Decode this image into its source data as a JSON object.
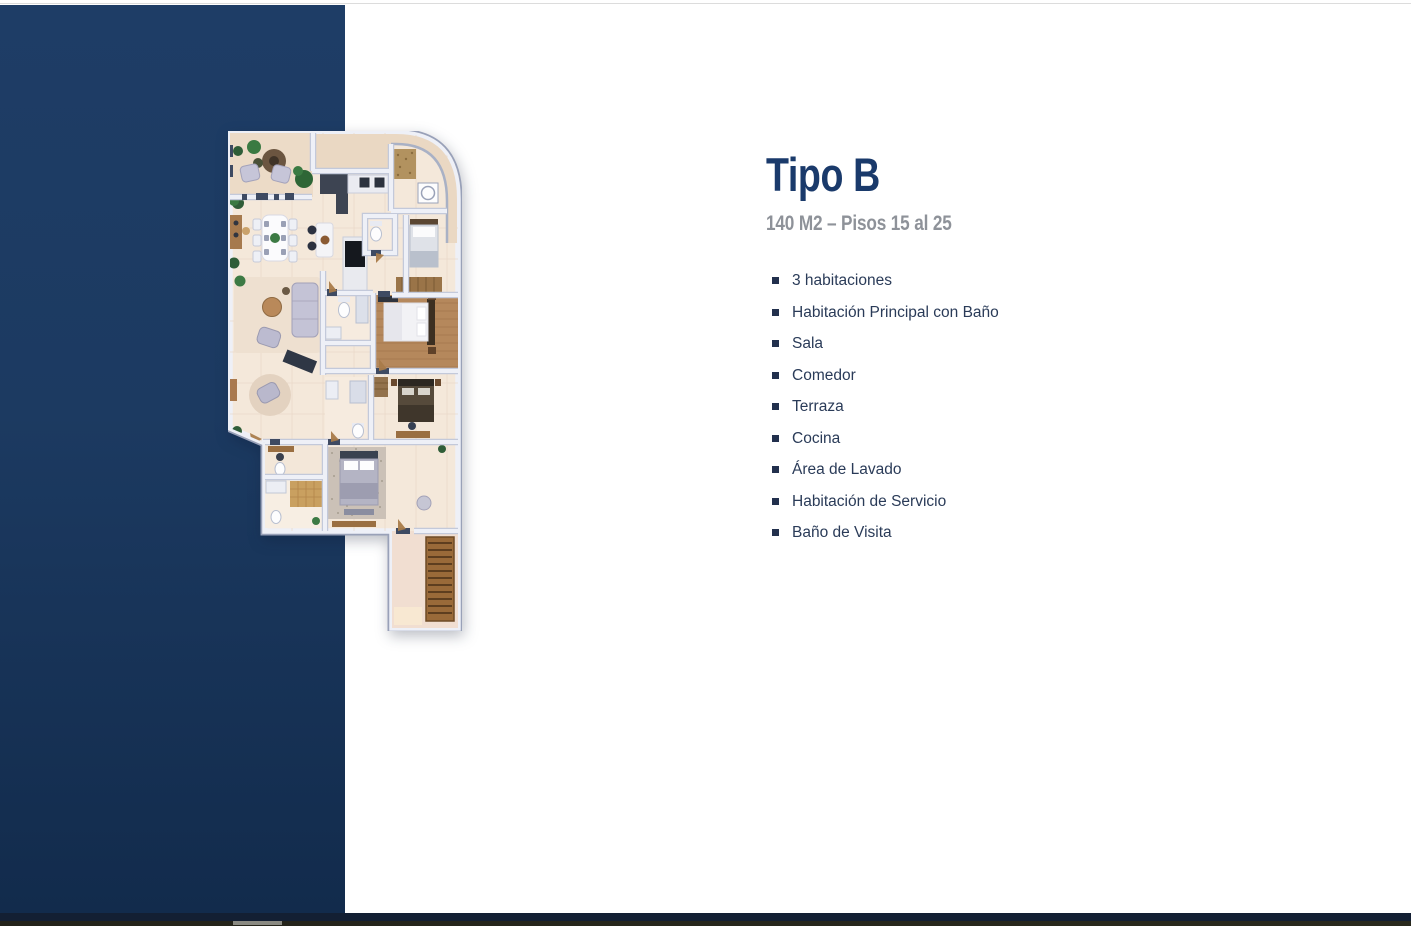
{
  "info": {
    "title": "Tipo B",
    "subtitle": "140 M2 – Pisos 15 al 25",
    "features": [
      "3 habitaciones",
      "Habitación Principal con Baño",
      "Sala",
      "Comedor",
      "Terraza",
      "Cocina",
      "Área de Lavado",
      "Habitación de Servicio",
      "Baño de Visita"
    ]
  },
  "floorplan": {
    "name": "apartment-floor-plan-top-view-tipo-b"
  },
  "colors": {
    "title_text": "#1a3a6b",
    "subtitle_text": "#8e9299",
    "feature_text": "#2a3b58",
    "bullet": "#22304d",
    "sidebar_gradient_top": "#1e3d66",
    "sidebar_gradient_bottom": "#122b4c",
    "taskbar_navy": "#131f33",
    "taskbar_olive": "#23231a",
    "taskbar_segment": "#8a8a82"
  }
}
